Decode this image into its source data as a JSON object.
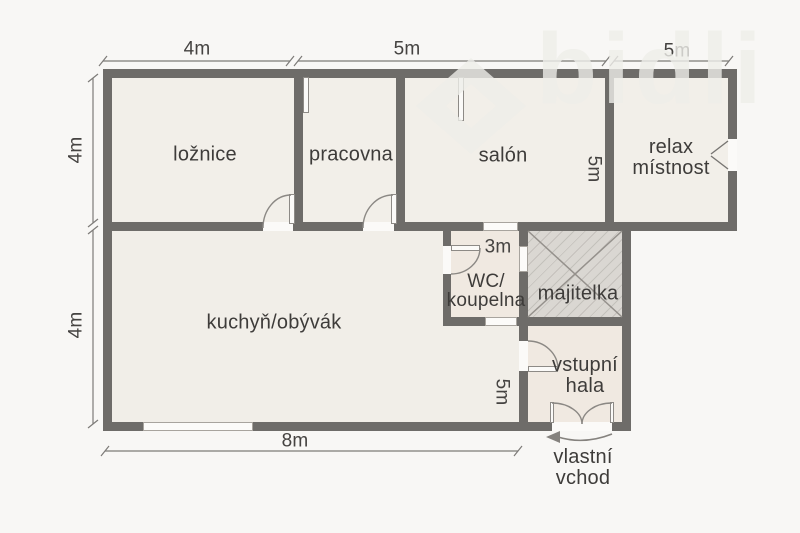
{
  "watermark": {
    "text": "bidli"
  },
  "rooms": {
    "loznice": {
      "label": "ložnice"
    },
    "pracovna": {
      "label": "pracovna"
    },
    "salon": {
      "label": "salón"
    },
    "relax": {
      "line1": "relax",
      "line2": "místnost"
    },
    "kuchyn": {
      "label": "kuchyň/obývák"
    },
    "wc": {
      "line1": "WC/",
      "line2": "koupelna"
    },
    "majitelka": {
      "label": "majitelka"
    },
    "hala": {
      "line1": "vstupní",
      "line2": "hala"
    }
  },
  "dimensions": {
    "top_1": "4m",
    "top_2": "5m",
    "top_3": "5m",
    "left_1": "4m",
    "left_2": "4m",
    "bottom": "8m",
    "wc_width": "3m",
    "salon_depth": "5m",
    "hala_depth": "5m"
  },
  "entrance": {
    "line1": "vlastní",
    "line2": "vchod"
  },
  "colors": {
    "background": "#f8f7f5",
    "wall": "#6e6c69",
    "room_fill": "#f2efe9",
    "hatch_fill": "#dad7d2",
    "text": "#3e3c3a"
  }
}
